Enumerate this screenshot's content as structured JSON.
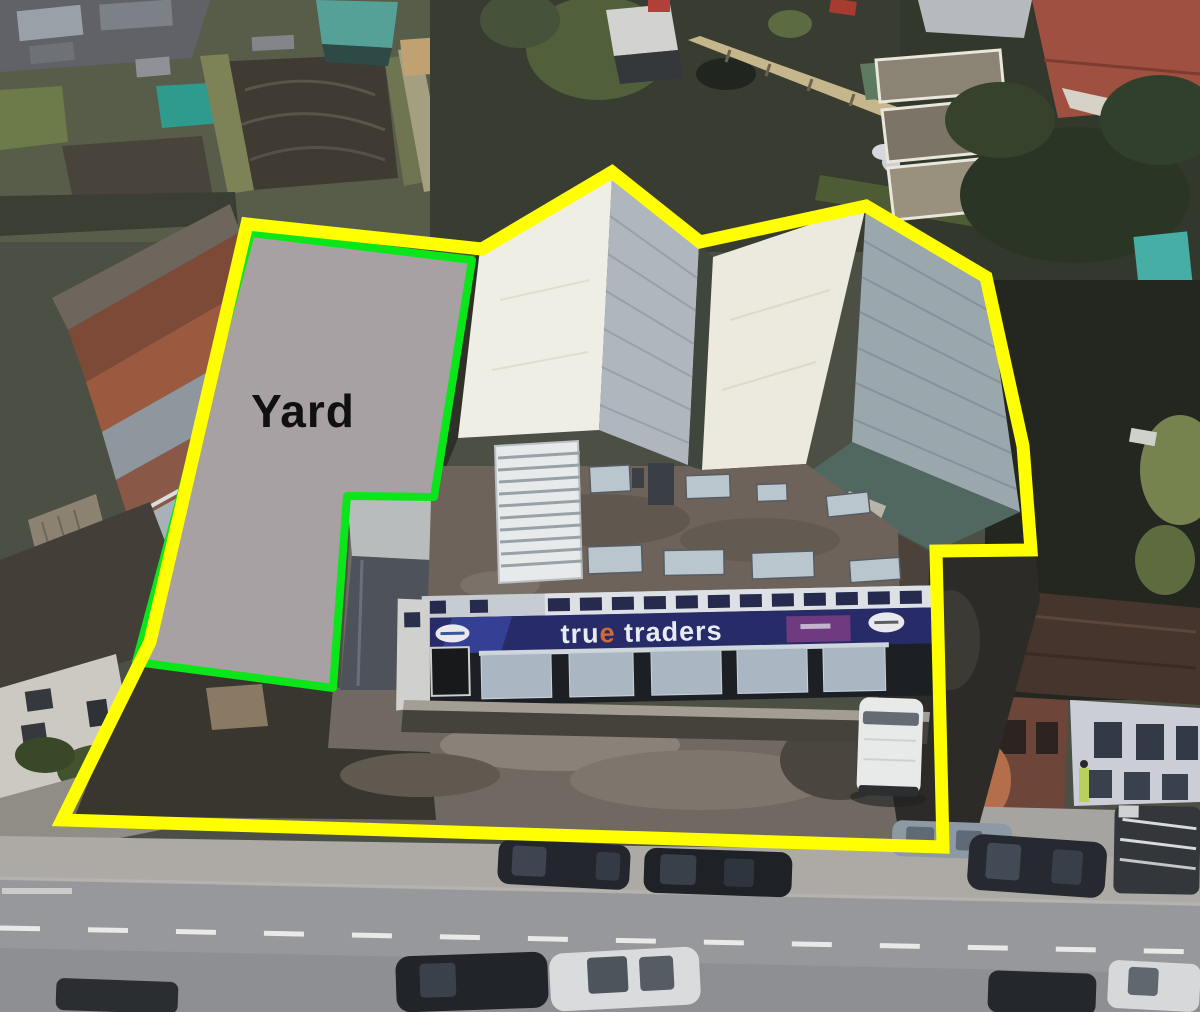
{
  "image": {
    "kind_label": "annotated aerial photograph of commercial premises",
    "overlays": {
      "yard_label": "Yard",
      "boundary_color": "#ffff00",
      "yard_outline_color": "#0ae619",
      "yard_fill_color": "#a8a1a3",
      "yard_label_color": "#101010"
    },
    "building": {
      "sign_text": "true traders",
      "sign_text_lead": "tru",
      "sign_text_accent": "e",
      "sign_text_tail": " traders",
      "sign_background_color": "#272c68",
      "sign_text_color": "#e7ebf2",
      "sign_accent_color": "#cf6a36"
    },
    "scene_colors": {
      "warehouse_white_roof": "#efeee4",
      "warehouse_grey_roof": "#b0b6bd",
      "warehouse_ribbed_roof": "#9aa7ad",
      "flat_roof": "#6d635b",
      "road": "#97989b",
      "pavement": "#adaaa6",
      "forecourt": "#6f6961"
    }
  }
}
